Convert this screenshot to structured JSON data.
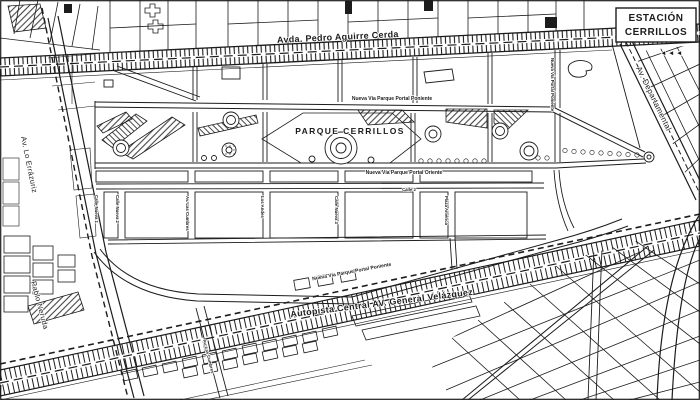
{
  "map": {
    "colors": {
      "paper": "#ffffff",
      "ink": "#1c1c1c"
    },
    "station": {
      "line1": "ESTACIÓN",
      "line2": "CERRILLOS",
      "icon": "◄◄◄"
    },
    "park_label": "PARQUE CERRILLOS",
    "streets": {
      "pedro_aguirre_cerda": "Avda. Pedro Aguirre Cerda",
      "autopista_velazquez": "Autopista Central AV. General Velázquez",
      "departamental": "Av. Departamental",
      "lo_errazuriz": "Av. Lo Errázuriz",
      "pablo_neruda": "Pablo Neruda",
      "portal_poniente_norte": "Nueva Vía Parque Portal Poniente",
      "portal_oriente": "Nueva Vía Parque Portal Oriente",
      "portal_poniente_sur": "Nueva Vía Parque Portal Poniente",
      "portal_poniente_vertical": "Nueva Vía Portal Poniente",
      "calle_2": "Calle 2",
      "calle_nueva_1": "Calle Nueva 1",
      "calle_nueva_2": "Calle Nueva 2",
      "calle_nueva_3": "Calle Nueva 3",
      "las_cumbres": "Av. Las Cumbres",
      "los_andes": "Los Andes",
      "plaza_america": "Plaza América",
      "las_cumbres_sur": "Av. Las Cumbres"
    }
  }
}
